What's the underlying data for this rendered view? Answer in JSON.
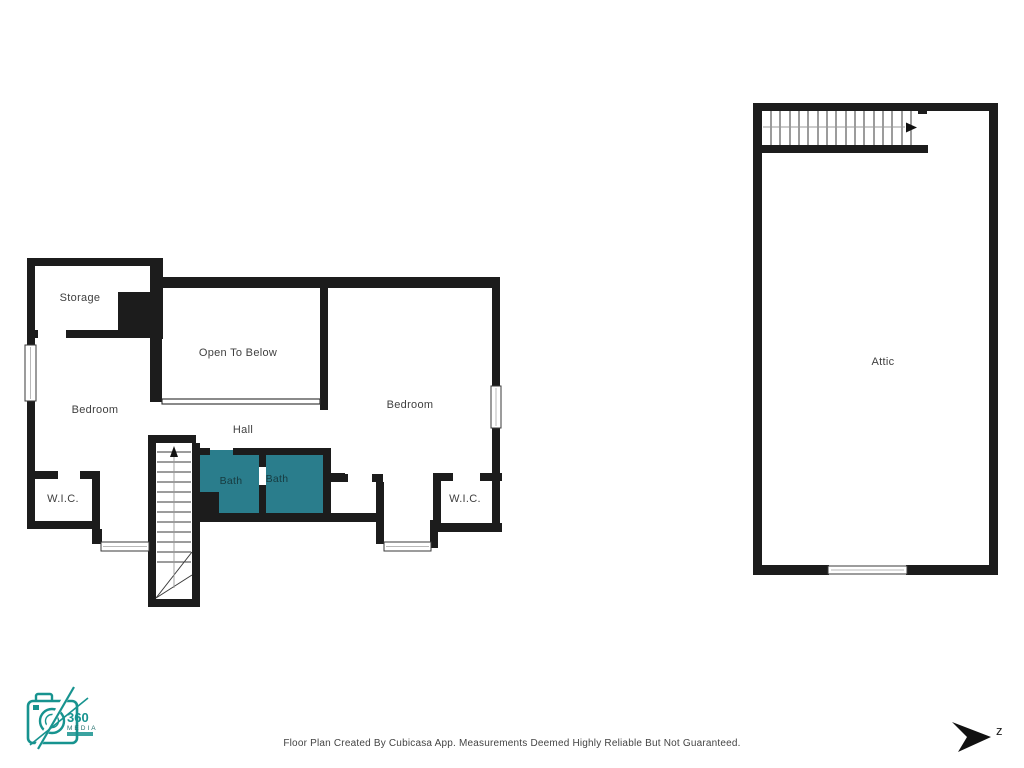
{
  "upper_floor": {
    "storage_label": "Storage",
    "open_to_below_label": "Open To Below",
    "bedroom_left_label": "Bedroom",
    "bedroom_right_label": "Bedroom",
    "hall_label": "Hall",
    "bath_left_label": "Bath",
    "bath_right_label": "Bath",
    "wic_left_label": "W.I.C.",
    "wic_right_label": "W.I.C."
  },
  "attic_floor": {
    "attic_label": "Attic"
  },
  "colors": {
    "wall_black": "#1c1c1c",
    "bath_teal": "#2a7d8c",
    "label_gray": "#3f3f3f",
    "logo_teal": "#17938f"
  },
  "branding": {
    "logo_number": "360",
    "logo_word": "MEDIA"
  },
  "compass": {
    "north_letter": "z"
  },
  "footer": {
    "disclaimer": "Floor Plan Created By Cubicasa App. Measurements Deemed Highly Reliable But Not Guaranteed."
  }
}
